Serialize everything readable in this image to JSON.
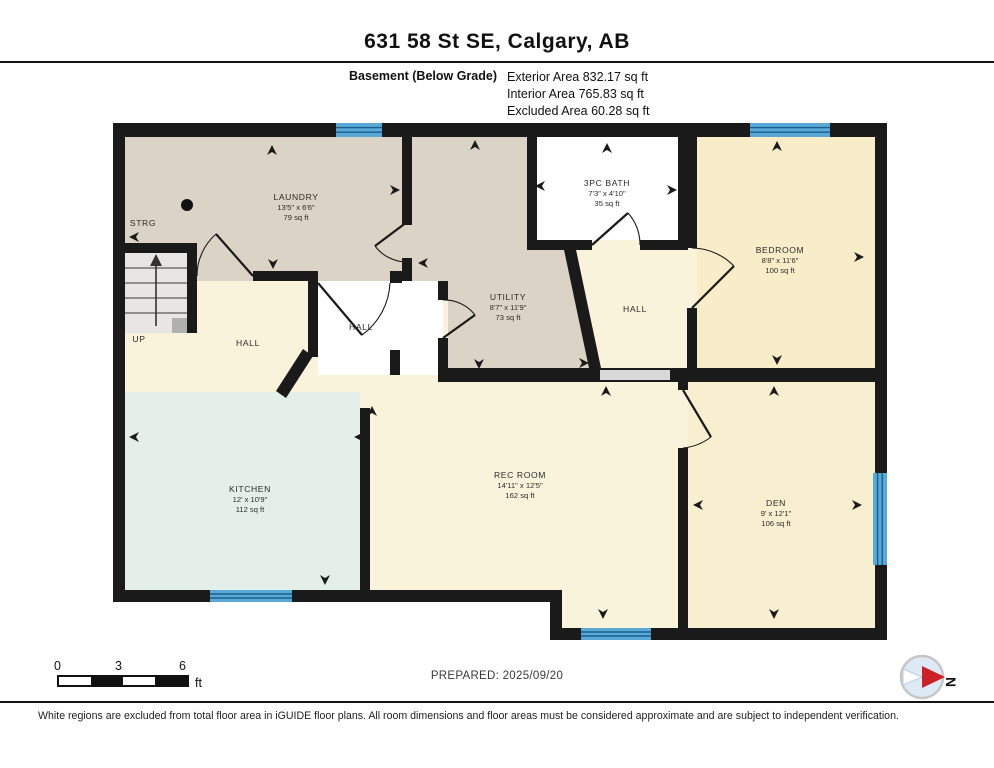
{
  "header": {
    "title": "631 58 St SE, Calgary, AB",
    "floor_label": "Basement (Below Grade)",
    "exterior_area": "Exterior Area 832.17 sq ft",
    "interior_area": "Interior Area 765.83 sq ft",
    "excluded_area": "Excluded Area 60.28 sq ft"
  },
  "rooms": {
    "laundry": {
      "name": "LAUNDRY",
      "dims": "13'5\" x 6'6\"",
      "area": "79 sq ft"
    },
    "strg": {
      "name": "STRG"
    },
    "up": {
      "name": "UP"
    },
    "hall_left": {
      "name": "HALL"
    },
    "hall_middle": {
      "name": "HALL"
    },
    "hall_right": {
      "name": "HALL"
    },
    "utility": {
      "name": "UTILITY",
      "dims": "8'7\" x 11'9\"",
      "area": "73 sq ft"
    },
    "bath": {
      "name": "3PC BATH",
      "dims": "7'3\" x 4'10\"",
      "area": "35 sq ft"
    },
    "bedroom": {
      "name": "BEDROOM",
      "dims": "8'8\" x 11'6\"",
      "area": "100 sq ft"
    },
    "kitchen": {
      "name": "KITCHEN",
      "dims": "12' x 10'9\"",
      "area": "112 sq ft"
    },
    "rec_room": {
      "name": "REC ROOM",
      "dims": "14'11\" x 12'5\"",
      "area": "162 sq ft"
    },
    "den": {
      "name": "DEN",
      "dims": "9' x 12'1\"",
      "area": "106 sq ft"
    }
  },
  "scale_bar": {
    "ticks": [
      "0",
      "3",
      "6"
    ],
    "unit": "ft"
  },
  "footer": {
    "prepared": "PREPARED: 2025/09/20",
    "disclaimer": "White regions are excluded from total floor area in iGUIDE floor plans. All room dimensions and floor areas must be considered approximate and are subject to independent verification.",
    "compass_label": "N"
  },
  "colors": {
    "wall": "#1a1a1a",
    "window": "#58a9d5",
    "tan": "#dbd3c5",
    "cream": "#faf3dc",
    "bedroom": "#f8edc8",
    "den": "#f8efd0",
    "kitchen": "#e4efe9",
    "compass_red": "#cc2127"
  }
}
